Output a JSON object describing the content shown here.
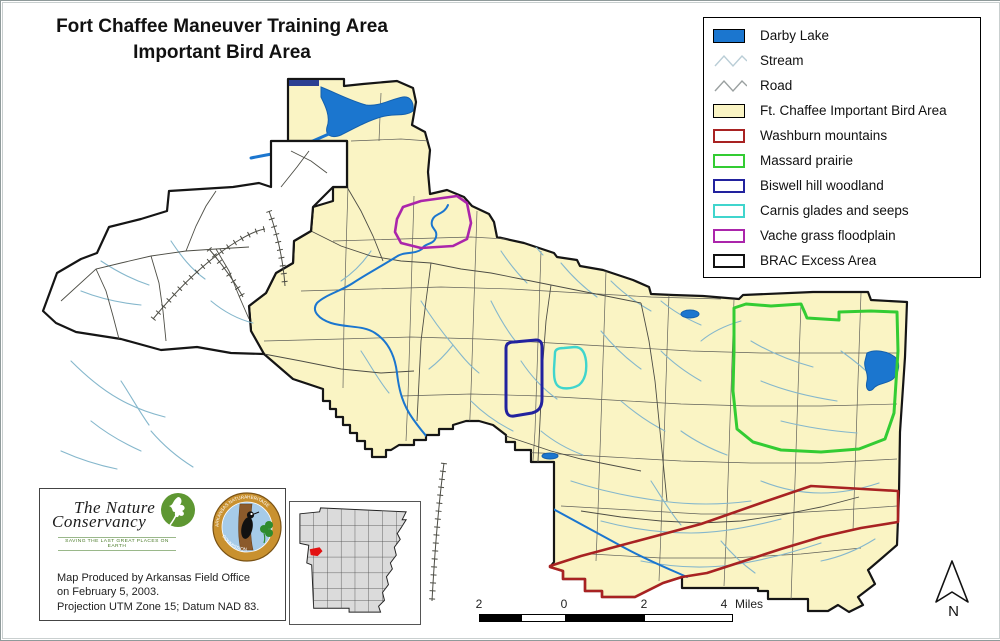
{
  "title": {
    "line1": "Fort Chaffee Maneuver Training Area",
    "line2": "Important Bird Area"
  },
  "legend": {
    "items": [
      {
        "label": "Darby Lake",
        "type": "fill",
        "color": "#1B76CF",
        "icon": "lake-swatch"
      },
      {
        "label": "Stream",
        "type": "line",
        "color": "#B9CDD6",
        "icon": "stream-line-icon"
      },
      {
        "label": "Road",
        "type": "line",
        "color": "#9AA0A0",
        "icon": "road-line-icon"
      },
      {
        "label": "Ft. Chaffee Important Bird Area",
        "type": "fill",
        "color": "#FAF4C4",
        "icon": "iba-swatch"
      },
      {
        "label": "Washburn mountains",
        "type": "outline",
        "color": "#A82222",
        "icon": "washburn-swatch"
      },
      {
        "label": "Massard prairie",
        "type": "outline",
        "color": "#33CC33",
        "icon": "massard-swatch"
      },
      {
        "label": "Biswell hill woodland",
        "type": "outline",
        "color": "#22229E",
        "icon": "biswell-swatch"
      },
      {
        "label": "Carnis glades and seeps",
        "type": "outline",
        "color": "#40D5CD",
        "icon": "carnis-swatch"
      },
      {
        "label": "Vache grass floodplain",
        "type": "outline",
        "color": "#AB25AB",
        "icon": "vache-swatch"
      },
      {
        "label": "BRAC Excess Area",
        "type": "outline",
        "color": "#111111",
        "icon": "brac-swatch"
      }
    ]
  },
  "credits": {
    "line1": "Map Produced by Arkansas Field Office",
    "line2": "on February 5, 2003.",
    "line3": "Projection UTM Zone 15; Datum NAD 83."
  },
  "logos": {
    "tnc_line1": "The Nature",
    "tnc_line2": "Conservancy",
    "tnc_tagline": "SAVING THE LAST GREAT PLACES ON EARTH"
  },
  "scalebar": {
    "labels": [
      "2",
      "0",
      "2",
      "4"
    ],
    "unit": "Miles"
  },
  "north_arrow": {
    "label": "N"
  },
  "map_colors": {
    "iba_fill": "#FAF4C4",
    "boundary": "#151515",
    "stream": "#85B7CC",
    "river": "#1B76CF",
    "river_edge": "#1460AD",
    "road": "#4D4D45",
    "compartment": "#61615A",
    "washburn": "#A82222",
    "massard": "#33CC33",
    "biswell": "#22229E",
    "carnis": "#40D5CD",
    "vache": "#AB25AB"
  }
}
